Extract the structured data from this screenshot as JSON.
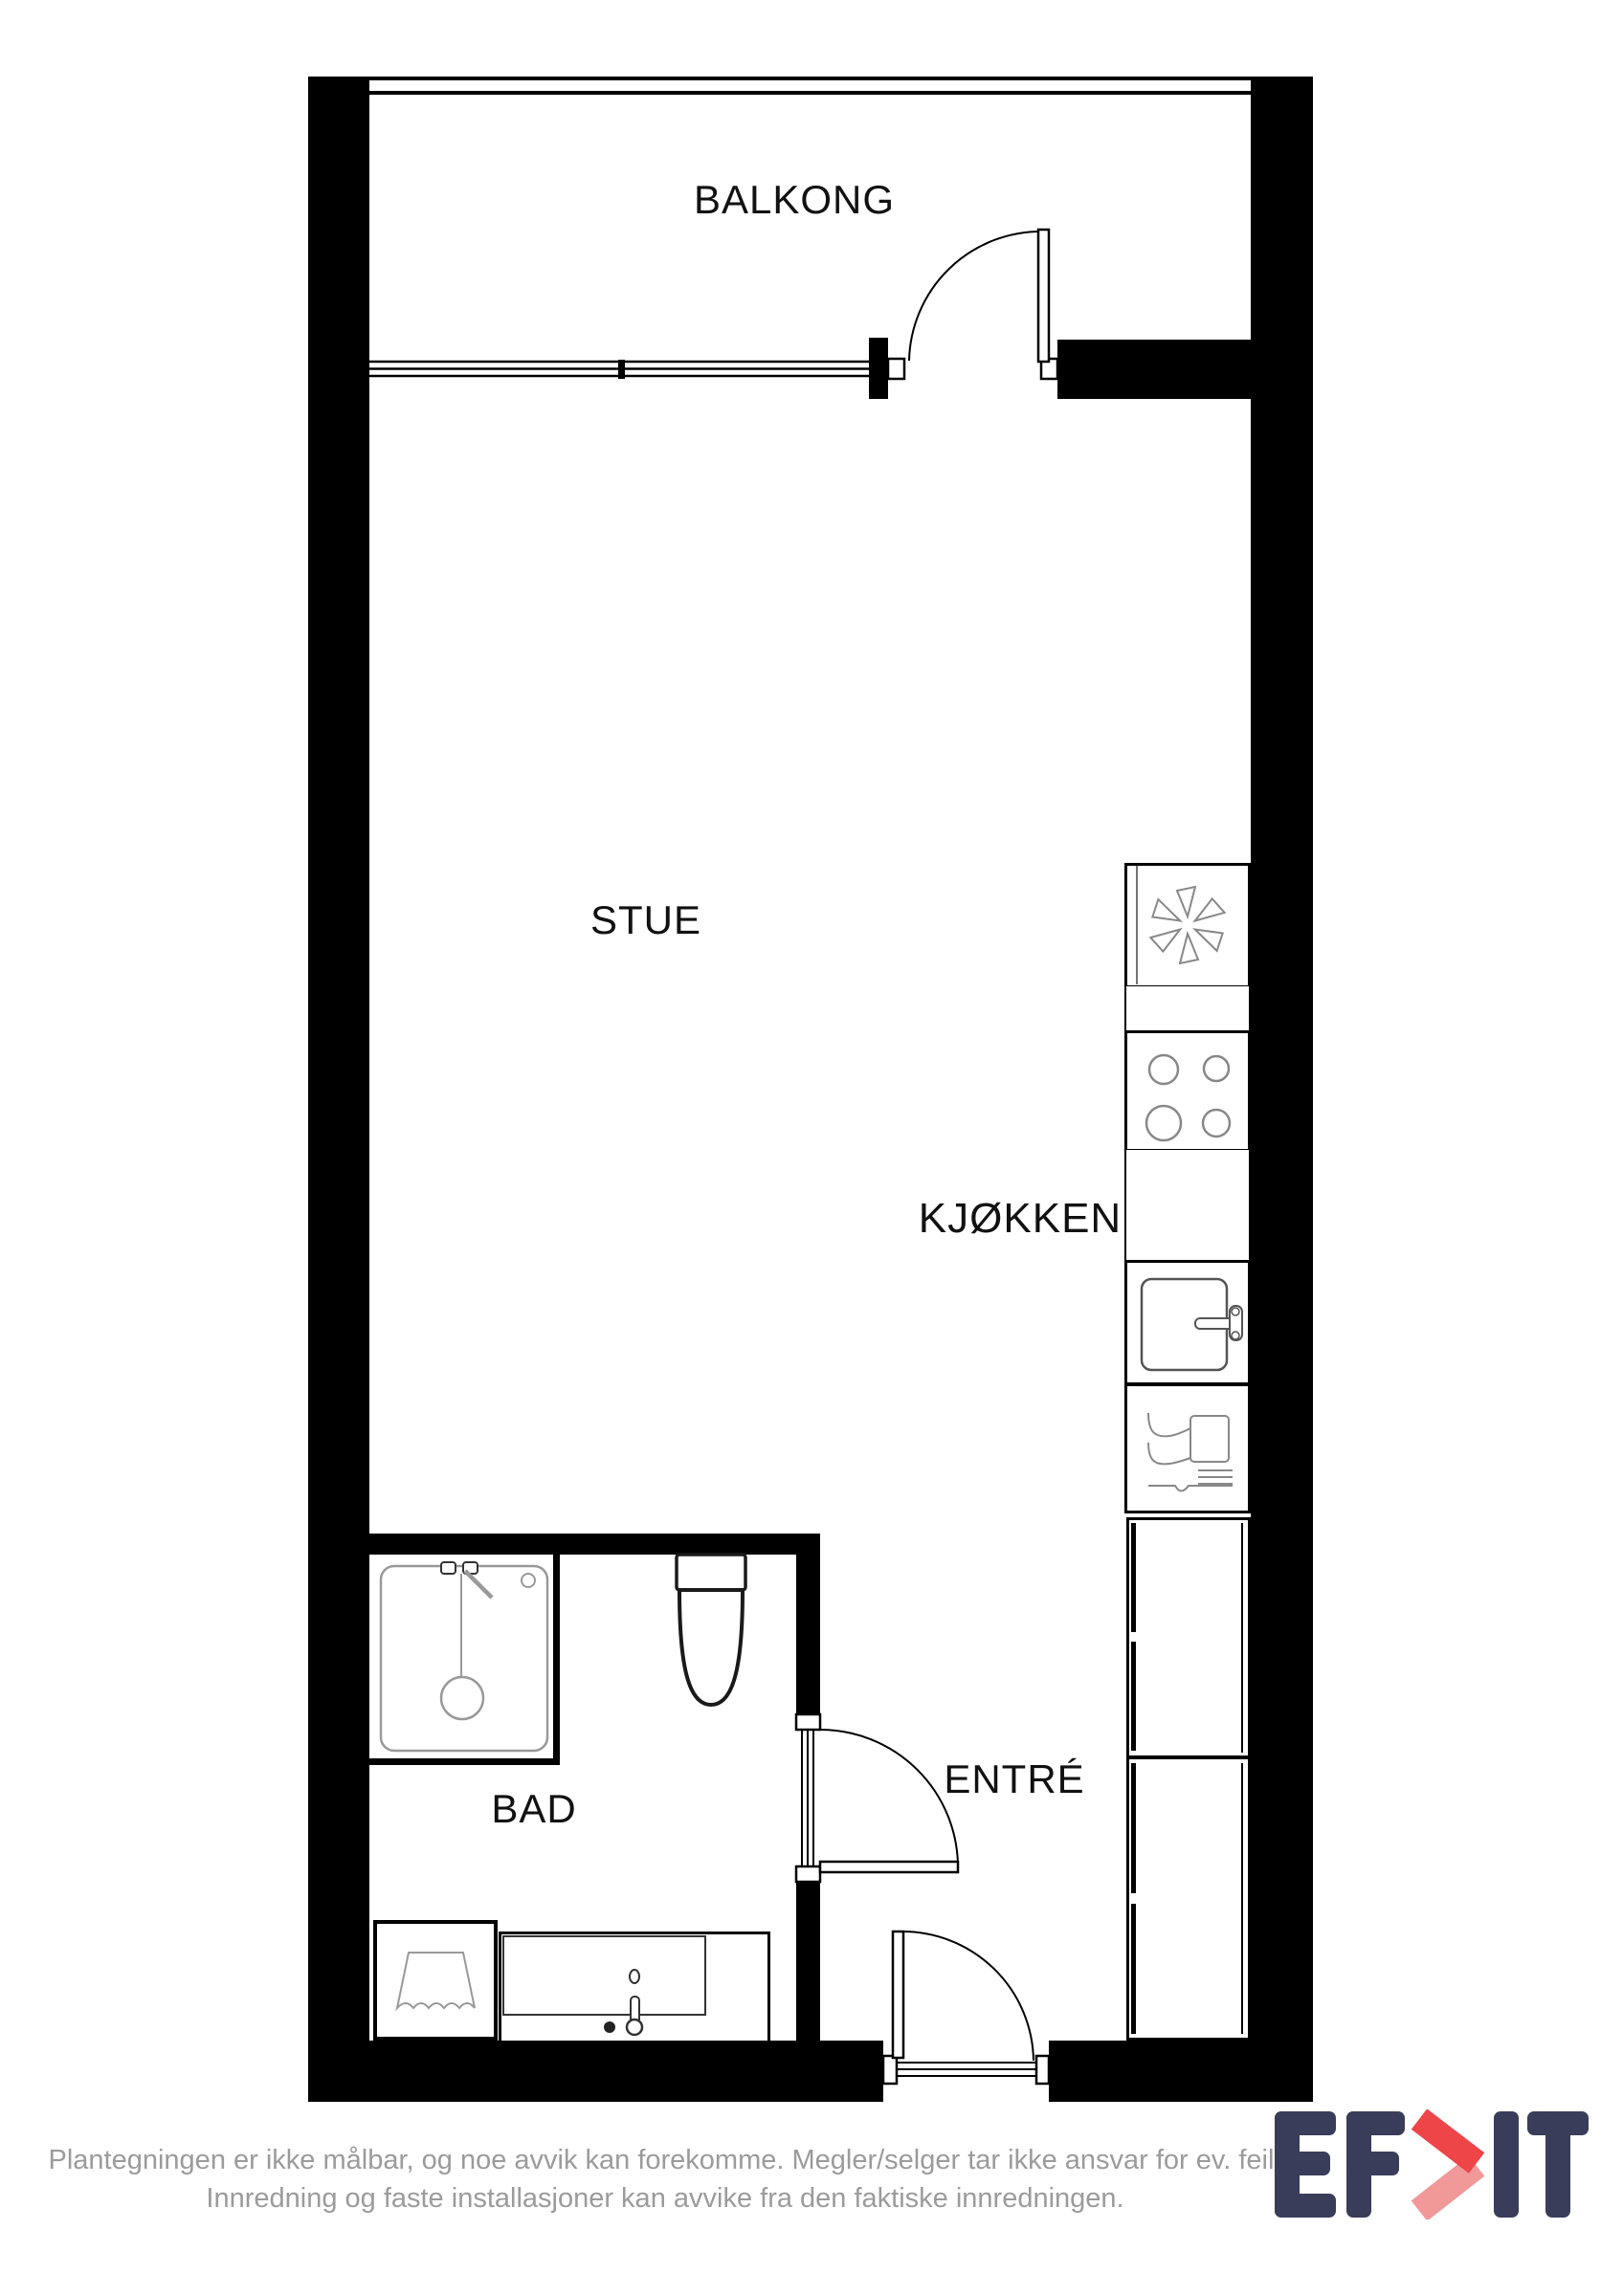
{
  "plan": {
    "labels": {
      "balcony": "BALKONG",
      "living_room": "STUE",
      "kitchen": "KJØKKEN",
      "bathroom": "BAD",
      "entrance": "ENTRÉ"
    }
  },
  "footer": {
    "line1": "Plantegningen er ikke målbar, og noe avvik kan forekomme. Megler/selger tar ikke ansvar for ev. feil.",
    "line2": "Innredning og faste installasjoner kan avvike fra den faktiske innredningen."
  },
  "logo": {
    "brand": "EFKT"
  },
  "colors": {
    "wall": "#000000",
    "label": "#111111",
    "footer_text": "#9b9b9b",
    "fixture_stroke": "#222222",
    "detail_stroke": "#999999",
    "logo_navy": "#393d59",
    "logo_red": "#ee4549",
    "logo_red_light": "#f19899"
  },
  "icons": {
    "fridge_freezer": "snowflake-fan-shape",
    "cooktop": "four-circle-burners",
    "kitchen_sink": "basin-with-faucet",
    "dishwasher": "glass-and-fork",
    "shower": "square-cabin-with-head",
    "toilet": "tank-and-bowl",
    "laundry": "basket-trapezoid",
    "vanity_sink": "counter-basin-with-tap",
    "doors": "quarter-circle-swing",
    "window": "triple-line",
    "railing": "double-line"
  }
}
